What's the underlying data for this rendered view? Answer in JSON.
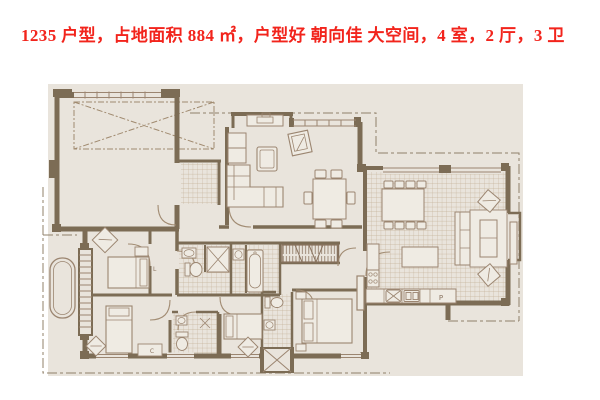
{
  "title": "1235 户型，占地面积 884 ㎡，户型好 朝向佳 大空间，4 室，2 厅，3 卫",
  "floor_plan": {
    "labels": {
      "fridge": "P",
      "hall": "L",
      "dresser": "C"
    },
    "colors": {
      "canvas": "#ffffff",
      "plan_background": "#e9e4dc",
      "wall_brown": "#7c6c55",
      "line_brown": "#9b8570",
      "tile_line": "#c3b197",
      "furniture_fill": "#efebe3",
      "title_red": "#f2241c"
    }
  }
}
